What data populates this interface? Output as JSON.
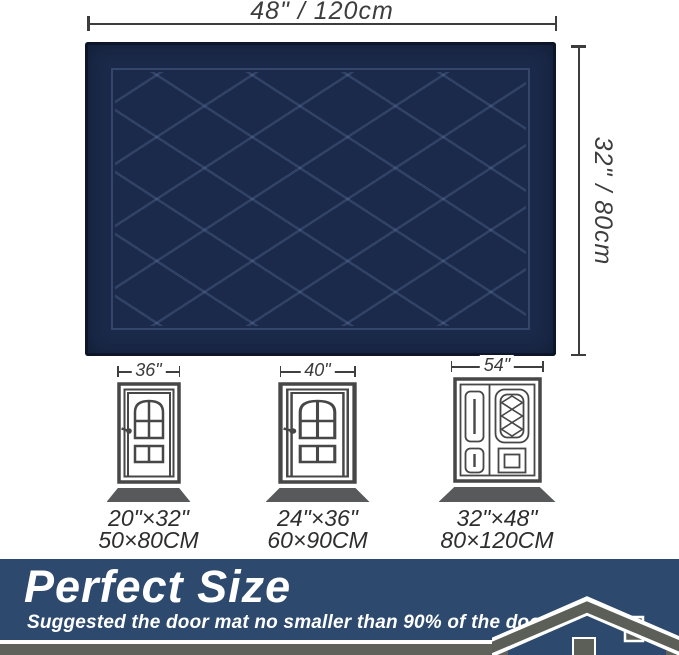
{
  "product_diagram": {
    "top_dimension": {
      "label": "48\" / 120cm"
    },
    "side_dimension": {
      "label": "32\" / 80cm"
    }
  },
  "doors": [
    {
      "door_width_label": "36\"",
      "mat_size_inches": "20\"×32\"",
      "mat_size_cm": "50×80CM",
      "door_type": "single"
    },
    {
      "door_width_label": "40\"",
      "mat_size_inches": "24\"×36\"",
      "mat_size_cm": "60×90CM",
      "door_type": "single"
    },
    {
      "door_width_label": "54\"",
      "mat_size_inches": "32\"×48\"",
      "mat_size_cm": "80×120CM",
      "door_type": "double"
    }
  ],
  "banner": {
    "title": "Perfect Size",
    "subtitle": "Suggested the door mat no smaller than 90% of the door width."
  },
  "colors": {
    "mat_navy": "#1b2a4a",
    "mat_groove_highlight": "#4d6aa0",
    "banner_blue": "#2d4a6e",
    "bottom_strip_gray": "#5f625b",
    "door_outline_gray": "#474747",
    "door_mat_gray": "#58595b",
    "dimension_text_gray": "#3d3d3d",
    "white": "#ffffff"
  }
}
